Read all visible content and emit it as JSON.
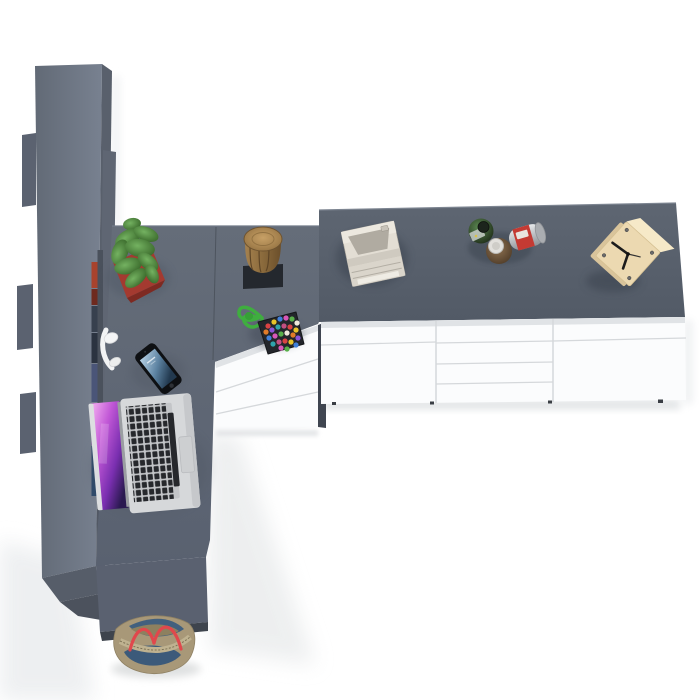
{
  "scene": {
    "name": "top-down office workspace render",
    "view": "bird's-eye 3D render, no UI chrome, no text"
  },
  "palette": {
    "floor": "#ffffff",
    "floor_shade": "#eceef0",
    "shelf_side": "#59606c",
    "shelf_bump": "#5b6270",
    "desk_seam": "#4d545e",
    "desk_front": "#5a6170",
    "desk_front_base": "#3e444d",
    "desk_side_dark": "#3f4550",
    "cabinet_white": "#fbfcfd",
    "cabinet_shadow_strip": "#e0e3e6",
    "cabinet_seam": "#d5d8db",
    "pot_red": "#a43a30",
    "pot_red_dark": "#7e2a22",
    "stump_mat": "#24282e",
    "candy_rope": "#3fae3f",
    "candy_pouch": "#23262b",
    "headphones_white": "#f2f3f4",
    "phone_body": "#0e1013",
    "laptop_body": "#d6d8da",
    "laptop_key": "#26282c",
    "printer_body": "#e3ded4",
    "printer_recess": "#b0aba1",
    "can_red": "#c43a33",
    "clock_wood": "#ecd9b1",
    "clock_wood_top": "#f6e9c8",
    "clock_hand": "#1c1c1c",
    "bag_body": "#a89878",
    "bag_denim": "#3c5a7a",
    "bag_denim_top": "#42607e",
    "bag_strap": "#e0484c",
    "bag_zip": "#bfb290"
  },
  "objects": {
    "shelf_unit": {
      "label": "tall cabinet seen from above"
    },
    "desk": {
      "label": "corner desk, dark grey top"
    },
    "pedestal": {
      "label": "white 3-drawer desk pedestal",
      "drawers": 3
    },
    "sideboard": {
      "label": "white sideboard with grey top",
      "sections": 3,
      "middle_drawers": 4
    },
    "plant": {
      "label": "cactus in red square pot"
    },
    "stump": {
      "label": "wooden stump stool on black mat"
    },
    "candy": {
      "label": "candy pouch with green ribbon",
      "dot_colors": [
        "#d94343",
        "#e8c32a",
        "#3f7fd9",
        "#d957b8",
        "#58b04a",
        "#efe9da",
        "#e07b28",
        "#8a55d9",
        "#2fa3ab",
        "#c24f82"
      ],
      "dots": [
        [
          268,
          326
        ],
        [
          274,
          322
        ],
        [
          280,
          319
        ],
        [
          286,
          318
        ],
        [
          292,
          319
        ],
        [
          297,
          323
        ],
        [
          266,
          332
        ],
        [
          272,
          330
        ],
        [
          278,
          327
        ],
        [
          284,
          326
        ],
        [
          290,
          327
        ],
        [
          296,
          330
        ],
        [
          269,
          338
        ],
        [
          275,
          336
        ],
        [
          281,
          334
        ],
        [
          287,
          333
        ],
        [
          293,
          335
        ],
        [
          298,
          338
        ],
        [
          273,
          344
        ],
        [
          279,
          342
        ],
        [
          285,
          341
        ],
        [
          291,
          342
        ],
        [
          296,
          345
        ],
        [
          281,
          348
        ],
        [
          287,
          349
        ]
      ]
    },
    "books": {
      "label": "book spines visible at shelf edge",
      "x": 91.5,
      "w": 6,
      "segments": [
        {
          "y": 262,
          "h": 26,
          "c": "#a8432d"
        },
        {
          "y": 289,
          "h": 16,
          "c": "#6e2a1f"
        },
        {
          "y": 306,
          "h": 26,
          "c": "#37404e"
        },
        {
          "y": 333,
          "h": 30,
          "c": "#2b3340"
        },
        {
          "y": 364,
          "h": 38,
          "c": "#4a5578"
        },
        {
          "y": 403,
          "h": 42,
          "c": "#8b3fa0"
        },
        {
          "y": 446,
          "h": 50,
          "c": "#2e4a6b"
        }
      ]
    },
    "headphones": {
      "label": "white headset draped on desk edge"
    },
    "phone": {
      "label": "smartphone with blue wallpaper"
    },
    "laptop": {
      "label": "open silver laptop, purple galaxy wallpaper"
    },
    "printer": {
      "label": "beige desktop printer"
    },
    "jar_green": {
      "label": "dark green jar"
    },
    "jar_brown": {
      "label": "brown jar with white lid"
    },
    "can": {
      "label": "silver can with red label, on its side"
    },
    "clock": {
      "label": "wooden cube clock, rotated"
    },
    "bag": {
      "label": "denim and leather tote bag with red straps"
    }
  }
}
